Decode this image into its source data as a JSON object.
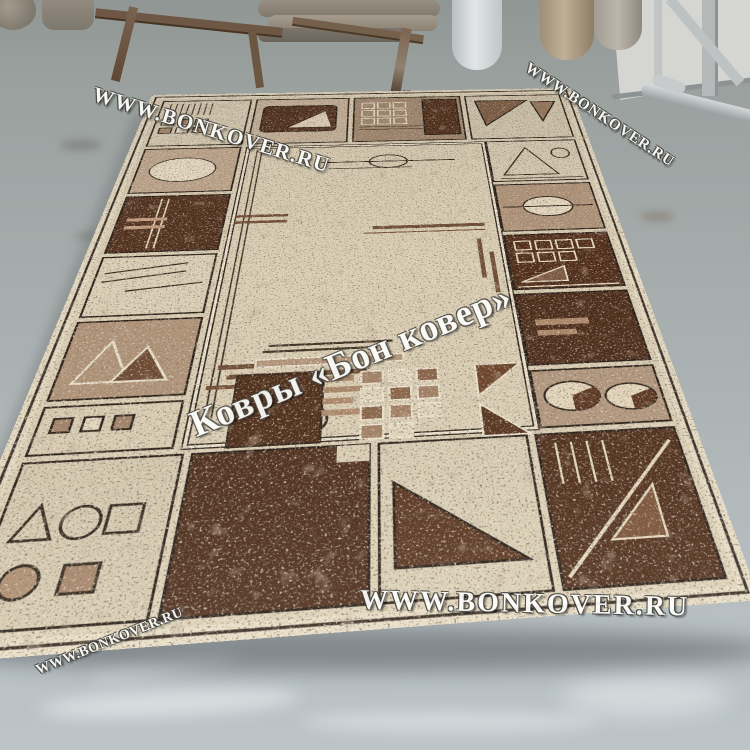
{
  "scene": {
    "description": "Photograph of a beige and brown geometric area rug lying at an angle on a gray concrete warehouse floor; rolled carpets, a rusty metal trestle, a white wall and metal shelving are visible along the top edge",
    "floor_color": "#aab2b5",
    "wall_color": "#d5d6d2"
  },
  "watermarks": {
    "top_left": "WWW.BONKOVER.RU",
    "top_right": "WWW.BONKOVER.RU",
    "center": "Ковры «Бон ковер»",
    "bottom": "WWW.BONKOVER.RU",
    "bottom_left": "WWW.BONKOVER.RU"
  },
  "carpet": {
    "style": "abstract geometric panel border with circles, triangles, square grids and comb motifs",
    "palette": {
      "cream": "#e9dfc7",
      "beige": "#e0d4ba",
      "tan": "#c4ab92",
      "brown": "#a58b72",
      "dark_brown": "#4b2a18",
      "outline": "#2b2117",
      "speckle": "#3d2c1f"
    }
  }
}
